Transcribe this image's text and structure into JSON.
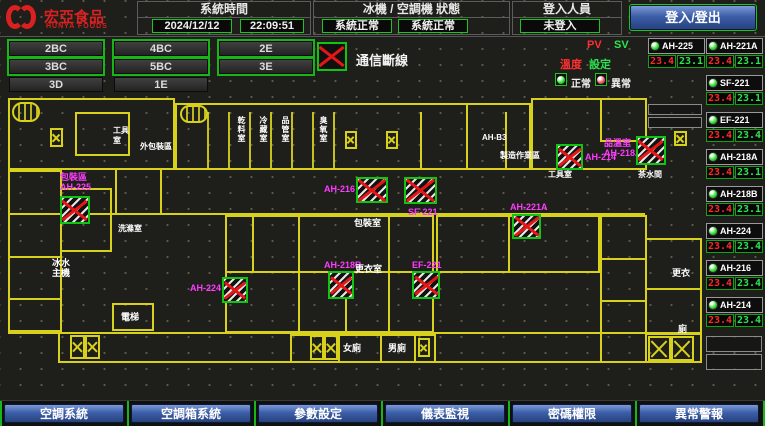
{
  "header": {
    "brand": "宏亞食品",
    "brand_sub": "HUNYA FOODS",
    "time_panel": {
      "title": "系統時間",
      "date": "2024/12/12",
      "time": "22:09:51"
    },
    "status_panel": {
      "title": "冰機 / 空調機 狀態",
      "left": "系統正常",
      "right": "系統正常"
    },
    "login_panel": {
      "title": "登入人員",
      "status": "未登入"
    },
    "login_button": "登入/登出"
  },
  "floor_buttons": [
    "2BC",
    "4BC",
    "2E",
    "3BC",
    "5BC",
    "3E",
    "3D",
    "1E"
  ],
  "legend": {
    "comm_fail": "通信斷線",
    "pv": "PV",
    "sv": "SV",
    "temp_pv": "溫度",
    "temp_sv": "設定",
    "normal": "正常",
    "abnormal": "異常"
  },
  "sidebar": {
    "items": [
      {
        "id": "AH-225",
        "pv": "23.4",
        "sv": "23.1"
      },
      {
        "id": "AH-221A",
        "pv": "23.4",
        "sv": "23.1"
      },
      {
        "id": "SF-221",
        "pv": "23.4",
        "sv": "23.1"
      },
      {
        "id": "EF-221",
        "pv": "23.4",
        "sv": "23.4"
      },
      {
        "id": "AH-218A",
        "pv": "23.4",
        "sv": "23.1"
      },
      {
        "id": "AH-218B",
        "pv": "23.4",
        "sv": "23.1"
      },
      {
        "id": "AH-224",
        "pv": "23.4",
        "sv": "23.4"
      },
      {
        "id": "AH-216",
        "pv": "23.4",
        "sv": "23.4"
      },
      {
        "id": "AH-214",
        "pv": "23.4",
        "sv": "23.4"
      }
    ]
  },
  "floorplan": {
    "comm_units": [
      {
        "label": "包裝區\nAH-225"
      },
      {
        "label": "AH-224"
      },
      {
        "label": "AH-216"
      },
      {
        "label": "SF-221"
      },
      {
        "label": "AH-221A"
      },
      {
        "label": "AH-214"
      },
      {
        "label": "品溫室\nAH-218A"
      },
      {
        "label": "AH-218B"
      },
      {
        "label": "EF-221"
      }
    ],
    "rooms": [
      "外包裝區",
      "工具\n室",
      "洗滌室",
      "乾料室",
      "冷藏室",
      "品管室",
      "臭氧室",
      "AH-B3",
      "製造作業區",
      "工具室",
      "茶水間",
      "包裝室",
      "更衣室",
      "冰水\n主機",
      "電梯",
      "女廁",
      "男廁",
      "更衣",
      "廁"
    ]
  },
  "bottom_nav": [
    "空調系統",
    "空調箱系統",
    "參數設定",
    "儀表監視",
    "密碼權限",
    "異常警報"
  ]
}
